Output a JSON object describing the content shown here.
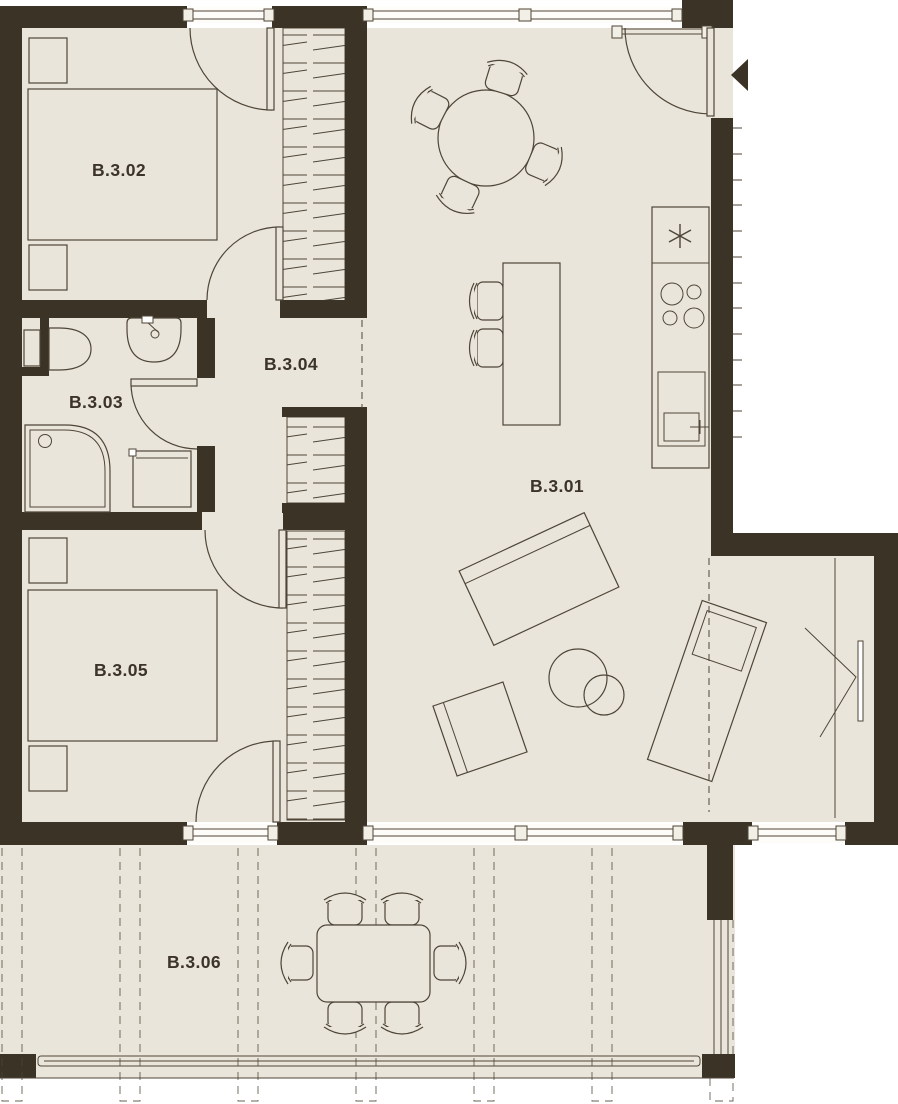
{
  "plan": {
    "title": "Apartment unit B.3 floor plan",
    "type": "architectural-floor-plan"
  },
  "rooms": [
    {
      "label": "B.3.01",
      "name": "living-room-kitchen"
    },
    {
      "label": "B.3.02",
      "name": "bedroom-1"
    },
    {
      "label": "B.3.03",
      "name": "bathroom"
    },
    {
      "label": "B.3.04",
      "name": "hallway"
    },
    {
      "label": "B.3.05",
      "name": "bedroom-2"
    },
    {
      "label": "B.3.06",
      "name": "terrace"
    }
  ],
  "colors": {
    "wall": "#3a3326",
    "floor": "#e9e5da",
    "outline": "#4e4537",
    "label": "#3c342a",
    "background": "#ffffff"
  },
  "icons": [
    "double-bed-icon",
    "nightstand-icon",
    "wardrobe-hatch-icon",
    "toilet-icon",
    "washbasin-icon",
    "shower-icon",
    "washing-machine-icon",
    "round-dining-table-icon",
    "dining-chair-icon",
    "bar-counter-icon",
    "bar-stool-icon",
    "fridge-asterisk-icon",
    "cooktop-burners-icon",
    "kitchen-sink-icon",
    "sofa-icon",
    "coffee-table-icon",
    "armchair-icon",
    "chaise-lounge-icon",
    "tv-panel-icon",
    "outdoor-dining-table-icon",
    "outdoor-chair-icon",
    "entrance-arrow-icon",
    "door-swing-icon",
    "window-icon",
    "column-grid-icon",
    "railing-icon"
  ]
}
